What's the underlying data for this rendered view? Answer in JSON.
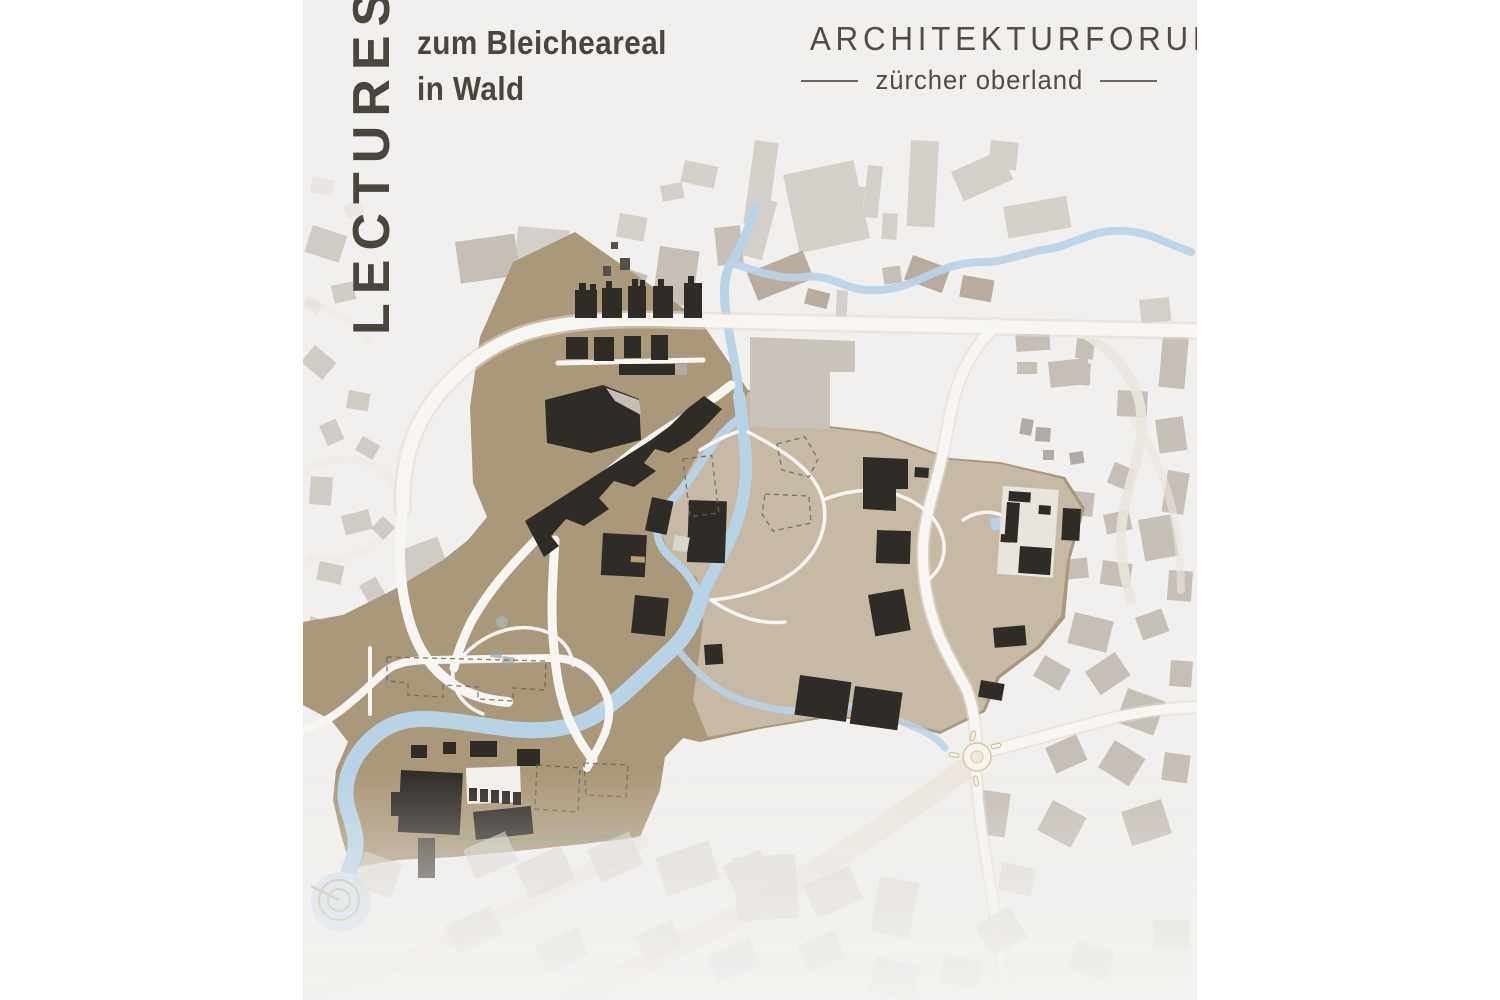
{
  "page": {
    "background": "#ffffff"
  },
  "poster": {
    "background": "#f1f0ee",
    "header": {
      "title_vertical": "LECTURES",
      "subtitle_line1": "zum Bleicheareal",
      "subtitle_line2": "in Wald",
      "text_color": "#4a463d"
    },
    "logo": {
      "line1": "ARCHITEKTURFORUM",
      "line2": "zürcher oberland",
      "color": "#514d42"
    },
    "map": {
      "description": "site plan of the Bleiche area in Wald ZH",
      "colors": {
        "site_area": "#aa987a",
        "site_area_light": "#c6baa6",
        "site_buildings": "#2f2b27",
        "context_light": "#d4cfc9",
        "context_mid": "#c6bfb7",
        "context_dark": "#b3aba3",
        "context_brown": "#b9ab9d",
        "context_faded": "#d9d4cf",
        "water": "#b9d3e6",
        "pond": "#d2e2ee",
        "roads": "#f8f6f3",
        "road_casing": "#e6ddd2",
        "roads_faded": "#ece5de",
        "dashed_outline": "#6b665c",
        "hedge_green": "#86a17b",
        "spiral": "#c8ab79",
        "courtyard": "#e9e4dd"
      },
      "features": [
        "site-area",
        "river",
        "canal-loop",
        "stream-branch-east",
        "stream-branch-southeast",
        "spiral-pond",
        "roundabout",
        "main-road",
        "factory-buildings",
        "planned-building-outlines",
        "context-buildings"
      ]
    }
  }
}
